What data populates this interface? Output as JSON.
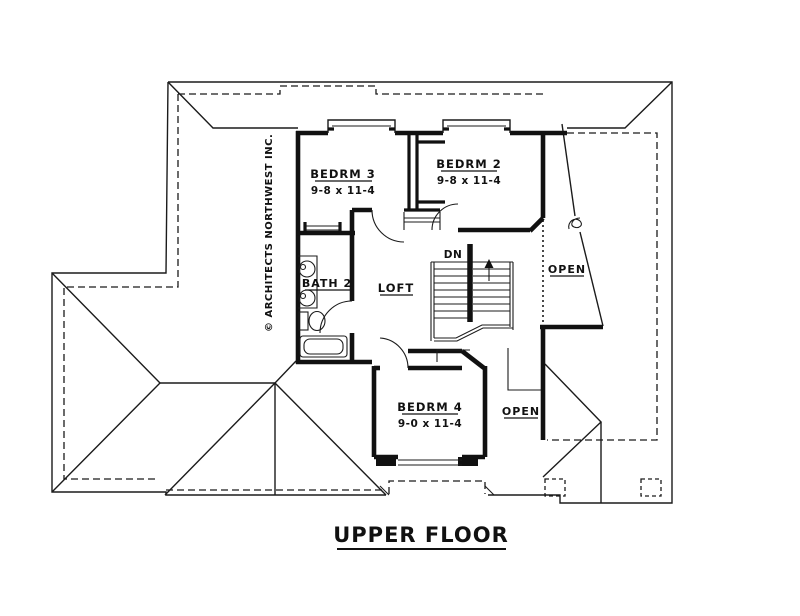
{
  "drawing": {
    "title": "UPPER FLOOR",
    "copyright": "© ARCHITECTS NORTHWEST INC.",
    "colors": {
      "line": "#1b1b1b",
      "background": "#ffffff"
    },
    "rooms": {
      "bedrm3": {
        "name": "BEDRM 3",
        "dims": "9-8 x 11-4"
      },
      "bedrm2": {
        "name": "BEDRM 2",
        "dims": "9-8 x 11-4"
      },
      "bedrm4": {
        "name": "BEDRM 4",
        "dims": "9-0 x 11-4"
      },
      "bath2": {
        "name": "BATH 2"
      },
      "loft": {
        "name": "LOFT"
      }
    },
    "annotations": {
      "stairs_down": "DN",
      "open_upper_right": "OPEN",
      "open_lower_right": "OPEN"
    }
  }
}
